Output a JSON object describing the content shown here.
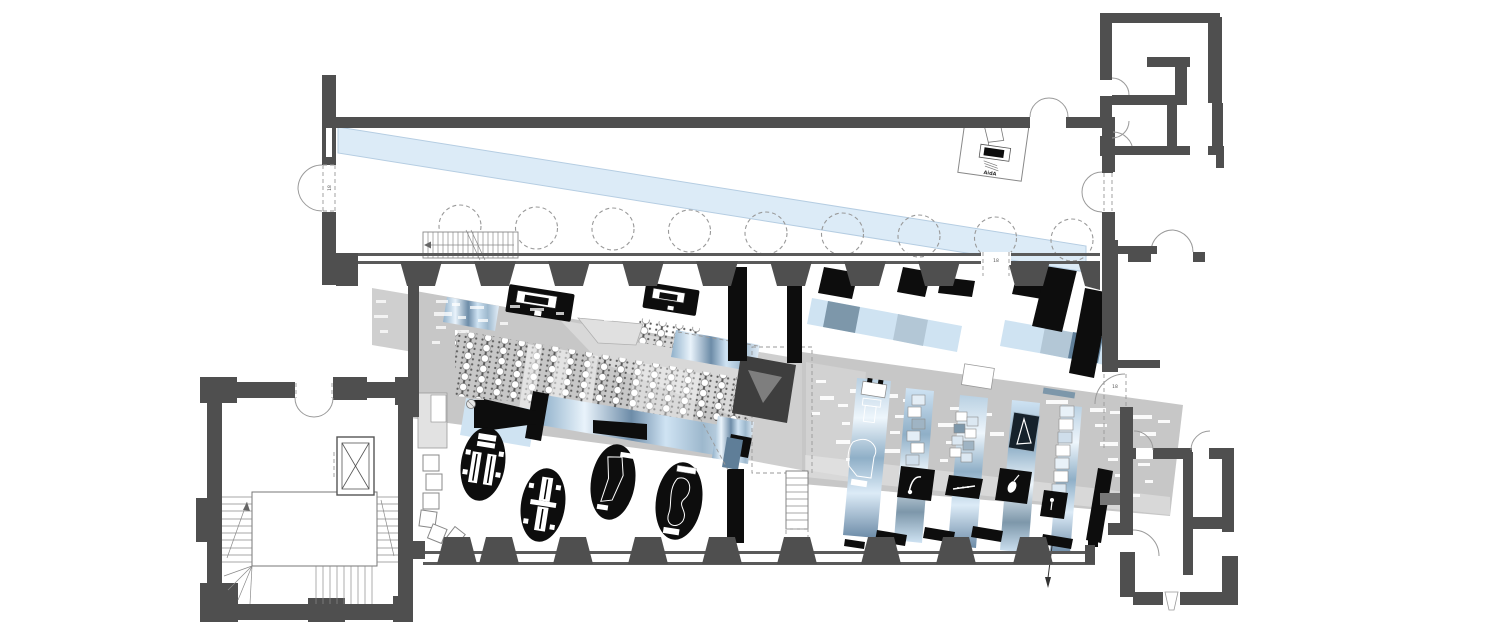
{
  "labels": {
    "reception_desk": "AidA",
    "door_west": "18",
    "door_mid": "18",
    "door_east": "18"
  },
  "colors": {
    "wall": "#4f4f4f",
    "ink": "#0d0d0d",
    "carpet": "#c7c7c7",
    "carpet_light": "#cfcfcf",
    "skylight": "#dcebf7",
    "skylight_edge": "#b5cde2",
    "blue_light": "#cfe3f2",
    "blue_steel": "#7d97aa",
    "blue_deep": "#5f7e98",
    "pale_blue": "#e9f3fb",
    "line_gray": "#8a8a8a",
    "paper": "#ffffff"
  }
}
